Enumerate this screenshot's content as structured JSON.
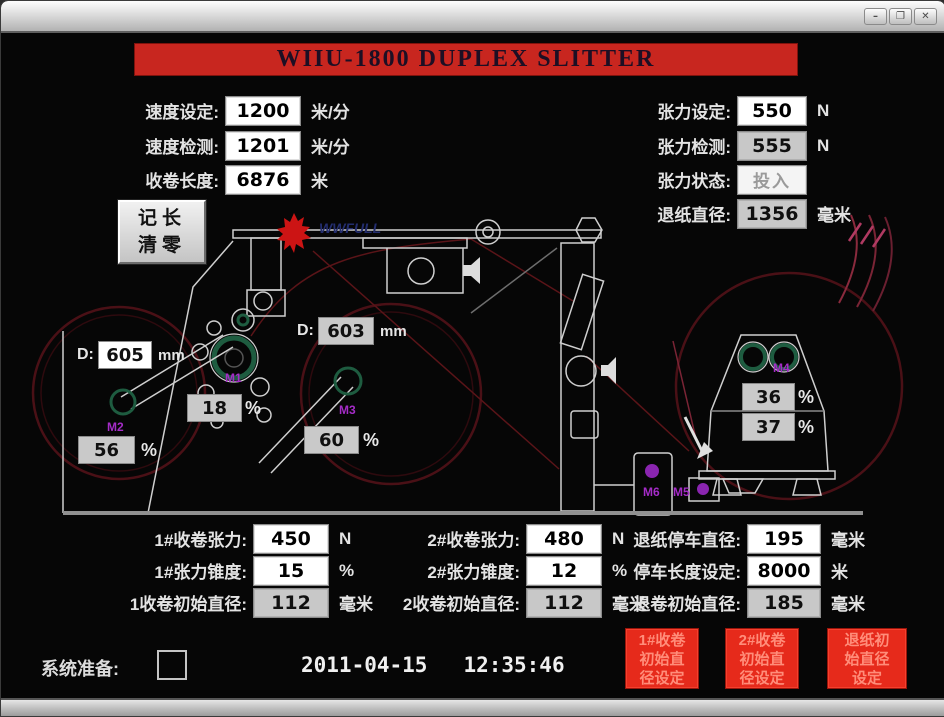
{
  "window": {
    "minimize": "–",
    "maximize": "❐",
    "close": "✕"
  },
  "title": "WIIU-1800 DUPLEX SLITTER",
  "top_left": [
    {
      "label": "速度设定:",
      "value": "1200",
      "unit": "米/分"
    },
    {
      "label": "速度检测:",
      "value": "1201",
      "unit": "米/分"
    },
    {
      "label": "收卷长度:",
      "value": "6876",
      "unit": "米"
    }
  ],
  "top_right": [
    {
      "label": "张力设定:",
      "value": "550",
      "unit": "N"
    },
    {
      "label": "张力检测:",
      "value": "555",
      "unit": "N"
    },
    {
      "label": "张力状态:",
      "value": "投入",
      "unit": ""
    },
    {
      "label": "退纸直径:",
      "value": "1356",
      "unit": "毫米"
    }
  ],
  "clear_button": {
    "line1": "记长",
    "line2": "清零"
  },
  "diagram": {
    "d1_prefix": "D:",
    "d1_value": "605",
    "d1_unit": "mm",
    "d2_prefix": "D:",
    "d2_value": "603",
    "d2_unit": "mm",
    "pct_left": "56",
    "pct_drum": "18",
    "pct_mid": "60",
    "pct_unwind_upper": "36",
    "pct_unwind_lower": "37",
    "percent": "%",
    "motors": {
      "m1": "M1",
      "m2": "M2",
      "m3": "M3",
      "m4": "M4",
      "m5": "M5",
      "m6": "M6"
    },
    "brand": "WWFULL"
  },
  "bottom_col1": [
    {
      "label": "1#收卷张力:",
      "value": "450",
      "unit": "N"
    },
    {
      "label": "1#张力锥度:",
      "value": "15",
      "unit": "%"
    },
    {
      "label": "1收卷初始直径:",
      "value": "112",
      "unit": "毫米"
    }
  ],
  "bottom_col2": [
    {
      "label": "2#收卷张力:",
      "value": "480",
      "unit": "N"
    },
    {
      "label": "2#张力锥度:",
      "value": "12",
      "unit": "%"
    },
    {
      "label": "2收卷初始直径:",
      "value": "112",
      "unit": "毫米"
    }
  ],
  "bottom_col3": [
    {
      "label": "退纸停车直径:",
      "value": "195",
      "unit": "毫米"
    },
    {
      "label": "停车长度设定:",
      "value": "8000",
      "unit": "米"
    },
    {
      "label": "退卷初始直径:",
      "value": "185",
      "unit": "毫米"
    }
  ],
  "red_buttons": [
    {
      "l1": "1#收卷",
      "l2": "初始直",
      "l3": "径设定"
    },
    {
      "l1": "2#收卷",
      "l2": "初始直",
      "l3": "径设定"
    },
    {
      "l1": "退纸初",
      "l2": "始直径",
      "l3": "设定"
    }
  ],
  "status": {
    "label": "系统准备:",
    "date": "2011-04-15",
    "time": "12:35:46"
  },
  "colors": {
    "banner_red": "#c8261f",
    "button_red": "#e62a1b",
    "motor_purple": "#a52cc8"
  }
}
